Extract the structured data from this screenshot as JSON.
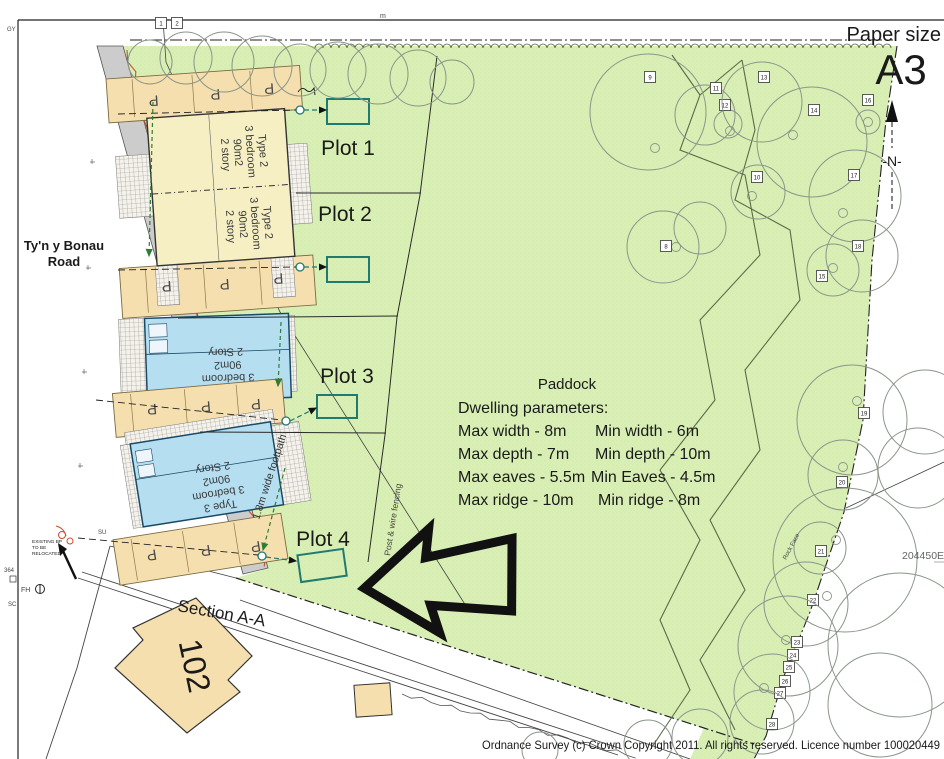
{
  "meta": {
    "paper_size_label": "Paper size",
    "paper_size_value": "A3",
    "north_label": "-N-"
  },
  "labels": {
    "road_line1": "Ty'n y Bonau",
    "road_line2": "Road",
    "footpath": "1.8m wide footpath",
    "paddock": "Paddock",
    "section": "Section A-A",
    "house_102": "102",
    "fencing": "Post & wire fencing",
    "rock_face": "Rock Face",
    "grid_ref": "204450E",
    "copyright": "Ordnance Survey (c) Crown Copyright 2011. All rights reserved. Licence number 100020449",
    "parking": "P",
    "existing_bp_1": "EXISTING BP",
    "existing_bp_2": "TO BE",
    "existing_bp_3": "RELOCATED",
    "fh": "FH",
    "gy": "GY",
    "su": "SU",
    "sc": "SC",
    "ref_364": "364",
    "top_cut": "m"
  },
  "plots": [
    {
      "name": "Plot 1"
    },
    {
      "name": "Plot 2"
    },
    {
      "name": "Plot 3"
    },
    {
      "name": "Plot 4"
    }
  ],
  "dwelling_types": {
    "type2": [
      "Type 2",
      "3 bedroom",
      "90m2",
      "2 story"
    ],
    "type3": [
      "Type 3",
      "3 bedroom",
      "90m2",
      "2 Story"
    ]
  },
  "parameters": {
    "title": "Dwelling parameters:",
    "rows": [
      {
        "max": "Max width - 8m",
        "min": "Min width - 6m"
      },
      {
        "max": "Max depth - 7m",
        "min": "Min depth - 10m"
      },
      {
        "max": "Max eaves - 5.5m",
        "min": "Min Eaves - 4.5m"
      },
      {
        "max": "Max ridge - 10m",
        "min": "Min ridge - 8m"
      }
    ]
  },
  "colors": {
    "site_green": "#d9efb5",
    "driveway_tan": "#f6dfae",
    "house_yellow": "#f6efc4",
    "house_blue": "#b5def1",
    "garage_teal": "#1f7a70",
    "hedge_red": "#c8502e",
    "footpath_grey": "#cccccc",
    "dash_green": "#2e7d32"
  },
  "trees": [
    {
      "x": 150,
      "y": 62,
      "r": 22,
      "box": [
        161,
        23,
        "1"
      ]
    },
    {
      "x": 186,
      "y": 58,
      "r": 26,
      "box": [
        177,
        23,
        "2"
      ]
    },
    {
      "x": 224,
      "y": 62,
      "r": 30
    },
    {
      "x": 262,
      "y": 66,
      "r": 30
    },
    {
      "x": 300,
      "y": 70,
      "r": 26
    },
    {
      "x": 338,
      "y": 70,
      "r": 28
    },
    {
      "x": 378,
      "y": 74,
      "r": 30
    },
    {
      "x": 418,
      "y": 78,
      "r": 28
    },
    {
      "x": 452,
      "y": 82,
      "r": 22
    },
    {
      "x": 648,
      "y": 112,
      "r": 58,
      "box": [
        650,
        77,
        "9"
      ],
      "t": [
        655,
        148
      ]
    },
    {
      "x": 705,
      "y": 115,
      "r": 30,
      "box": [
        716,
        88,
        "11"
      ]
    },
    {
      "x": 728,
      "y": 124,
      "r": 14,
      "box": [
        725,
        105,
        "12"
      ],
      "t": [
        730,
        131
      ]
    },
    {
      "x": 762,
      "y": 102,
      "r": 40,
      "box": [
        764,
        77,
        "13"
      ]
    },
    {
      "x": 812,
      "y": 142,
      "r": 55,
      "box": [
        814,
        110,
        "14"
      ],
      "t": [
        793,
        135
      ]
    },
    {
      "x": 868,
      "y": 122,
      "r": 12,
      "box": [
        868,
        100,
        "16"
      ],
      "t": [
        868,
        122
      ]
    },
    {
      "x": 758,
      "y": 192,
      "r": 27,
      "box": [
        757,
        177,
        "10"
      ],
      "t": [
        752,
        196
      ]
    },
    {
      "x": 855,
      "y": 196,
      "r": 46,
      "box": [
        854,
        175,
        "17"
      ],
      "t": [
        843,
        213
      ]
    },
    {
      "x": 862,
      "y": 256,
      "r": 36,
      "box": [
        858,
        246,
        "18"
      ]
    },
    {
      "x": 833,
      "y": 270,
      "r": 26,
      "box": [
        822,
        276,
        "15"
      ],
      "t": [
        833,
        268
      ]
    },
    {
      "x": 663,
      "y": 247,
      "r": 36,
      "box": [
        666,
        246,
        "8"
      ],
      "t": [
        676,
        247
      ]
    },
    {
      "x": 700,
      "y": 228,
      "r": 26
    },
    {
      "x": 852,
      "y": 420,
      "r": 55,
      "box": [
        864,
        413,
        "19"
      ],
      "t": [
        857,
        401
      ]
    },
    {
      "x": 843,
      "y": 475,
      "r": 35,
      "box": [
        842,
        482,
        "20"
      ],
      "t": [
        843,
        467
      ]
    },
    {
      "x": 845,
      "y": 560,
      "r": 72
    },
    {
      "x": 820,
      "y": 548,
      "r": 26,
      "box": [
        821,
        551,
        "21"
      ],
      "t": [
        836,
        540
      ]
    },
    {
      "x": 806,
      "y": 604,
      "r": 42,
      "box": [
        813,
        600,
        "22"
      ],
      "t": [
        827,
        596
      ]
    },
    {
      "x": 788,
      "y": 646,
      "r": 50,
      "box": [
        797,
        642,
        "23"
      ],
      "t": [
        786,
        640
      ]
    },
    {
      "box": [
        793,
        655,
        "24"
      ]
    },
    {
      "box": [
        789,
        667,
        "25"
      ]
    },
    {
      "box": [
        785,
        681,
        "26"
      ]
    },
    {
      "x": 772,
      "y": 692,
      "r": 38,
      "box": [
        780,
        693,
        "27"
      ],
      "t": [
        764,
        688
      ]
    },
    {
      "x": 762,
      "y": 722,
      "r": 32,
      "box": [
        772,
        724,
        "28"
      ]
    },
    {
      "x": 900,
      "y": 645,
      "r": 72
    },
    {
      "x": 918,
      "y": 468,
      "r": 40
    },
    {
      "x": 925,
      "y": 412,
      "r": 42
    },
    {
      "x": 880,
      "y": 705,
      "r": 52
    },
    {
      "x": 700,
      "y": 737,
      "r": 28
    },
    {
      "x": 648,
      "y": 744,
      "r": 24
    },
    {
      "x": 540,
      "y": 750,
      "r": 18
    }
  ]
}
